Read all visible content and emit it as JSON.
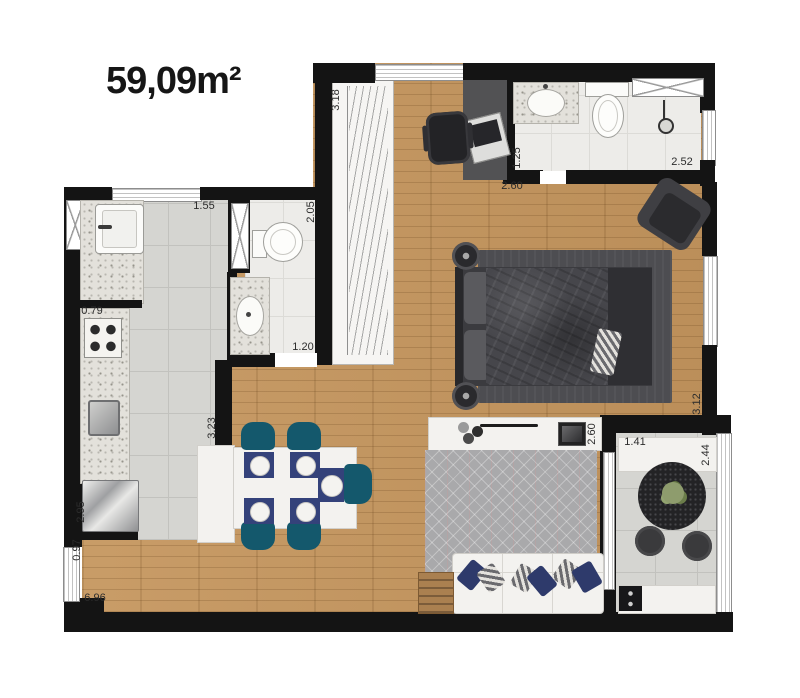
{
  "title": "59,09m²",
  "palette": {
    "wall": "#141414",
    "wood": "#c5965e",
    "tile_gray": "#d5d5d1",
    "tile_white": "#edece9",
    "rug_dark": "#4d4d51",
    "rug_gray": "#a9a9ab",
    "accent_teal": "#14586c",
    "accent_navy": "#34427a",
    "accent_navy2": "#2e3a6b"
  },
  "dimensions": [
    {
      "label": "1.55",
      "cx": 204,
      "cy": 206,
      "vertical": false
    },
    {
      "label": "2.05",
      "cx": 311,
      "cy": 212,
      "vertical": true
    },
    {
      "label": "3.18",
      "cx": 336,
      "cy": 100,
      "vertical": true
    },
    {
      "label": "2.60",
      "cx": 512,
      "cy": 186,
      "vertical": false
    },
    {
      "label": "1.25",
      "cx": 517,
      "cy": 158,
      "vertical": true
    },
    {
      "label": "2.52",
      "cx": 682,
      "cy": 162,
      "vertical": false
    },
    {
      "label": "0.79",
      "cx": 92,
      "cy": 311,
      "vertical": false
    },
    {
      "label": "1.20",
      "cx": 303,
      "cy": 347,
      "vertical": false
    },
    {
      "label": "3.23",
      "cx": 212,
      "cy": 428,
      "vertical": true
    },
    {
      "label": "2.95",
      "cx": 81,
      "cy": 512,
      "vertical": true
    },
    {
      "label": "0.97",
      "cx": 77,
      "cy": 550,
      "vertical": true
    },
    {
      "label": "6.96",
      "cx": 95,
      "cy": 598,
      "vertical": false
    },
    {
      "label": "2.60",
      "cx": 592,
      "cy": 434,
      "vertical": true
    },
    {
      "label": "3.12",
      "cx": 697,
      "cy": 404,
      "vertical": true
    },
    {
      "label": "1.41",
      "cx": 635,
      "cy": 442,
      "vertical": false
    },
    {
      "label": "2.44",
      "cx": 706,
      "cy": 455,
      "vertical": true
    }
  ]
}
